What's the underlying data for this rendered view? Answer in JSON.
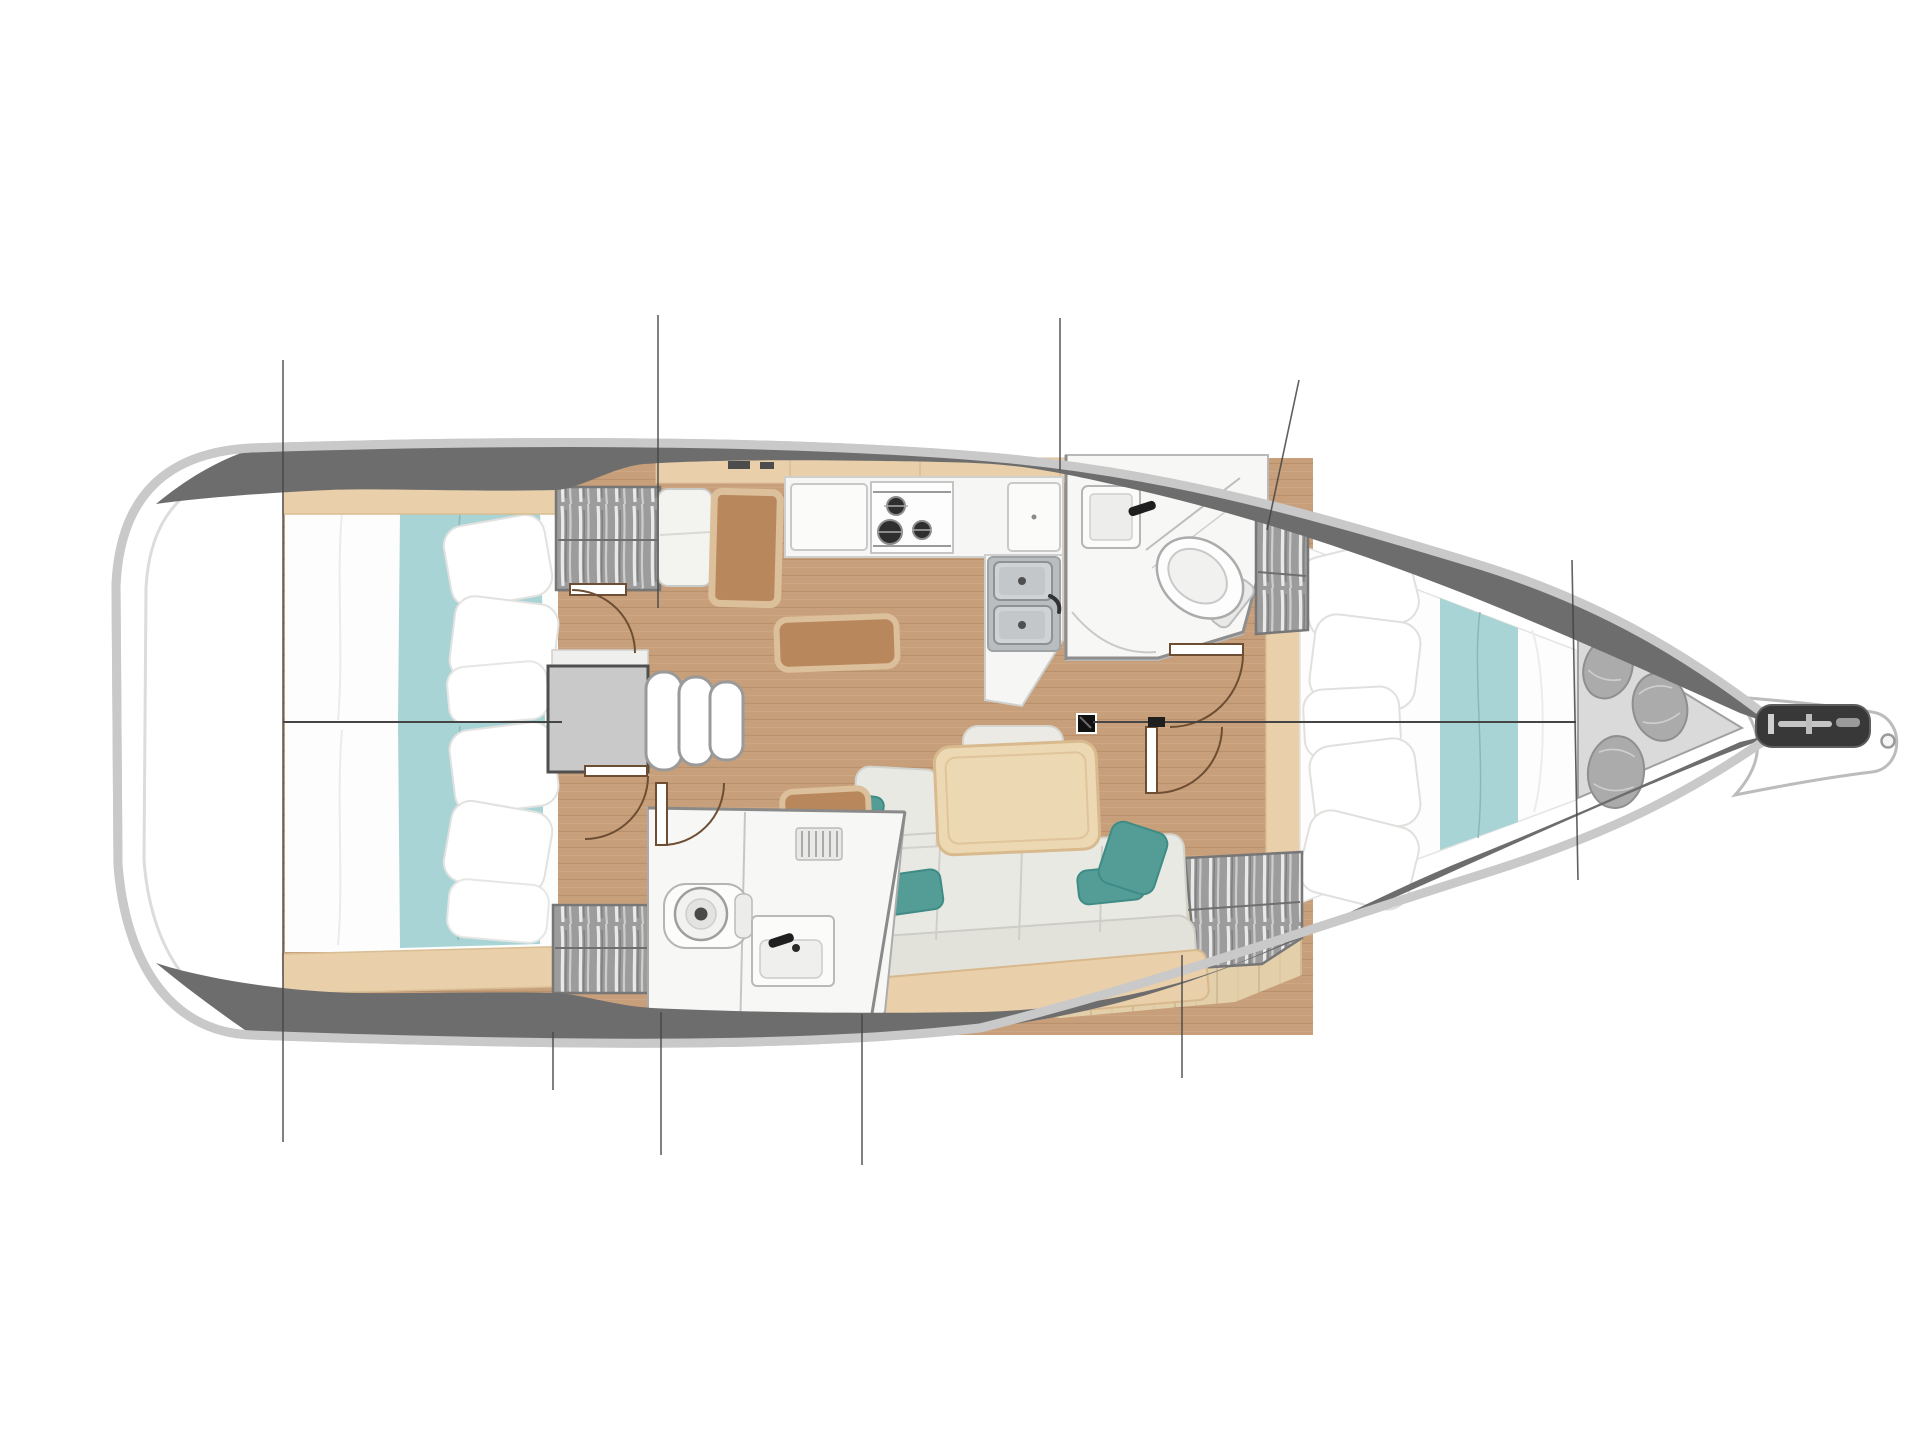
{
  "palette": {
    "hull_edge": "#c9c9c9",
    "hull_inner_line": "#dcdcdc",
    "deck_band_dark": "#585858",
    "deck_band": "#6d6d6d",
    "deck_band_light": "#7a7a7a",
    "floor_wood": "#c79f7a",
    "floor_wood_light": "#e3cfa9",
    "trim_wood": "#e9d0aa",
    "table_wood": "#ecd8b2",
    "desk_brown": "#b8875b",
    "desk_rim": "#dcbf9b",
    "teal_bedding": "#a9d4d6",
    "teal_pillow": "#549d96",
    "bed_white": "#fdfdfd",
    "room_white": "#f7f7f5",
    "wardrobe_gray": "#9c9c9c",
    "steel": "#b9bdc0",
    "landing_gray": "#c9c9c9",
    "sail_bag": "#ababab",
    "locker_floor": "#dadada",
    "line_dark": "#454545",
    "door_brown": "#6e4e33",
    "anchor_dark": "#383838"
  },
  "plan": {
    "vessel": "sailing-yacht-interior-floor-plan-top-view",
    "orientation": {
      "bow": "right",
      "stern": "left"
    },
    "rooms": [
      {
        "id": "aft-cabin-upper",
        "features": [
          "double-berth",
          "teal-runner",
          "pillows",
          "hanging-locker"
        ]
      },
      {
        "id": "aft-cabin-lower",
        "features": [
          "double-berth",
          "teal-runner",
          "pillows",
          "hanging-locker"
        ]
      },
      {
        "id": "aft-head",
        "features": [
          "toilet",
          "washbasin",
          "vent-grille"
        ]
      },
      {
        "id": "companionway",
        "features": [
          "landing",
          "three-steps",
          "seat",
          "chart-table"
        ]
      },
      {
        "id": "galley",
        "features": [
          "three-burner-stove",
          "double-sink",
          "counters",
          "storage-bench"
        ]
      },
      {
        "id": "saloon",
        "features": [
          "l-shaped-sofa",
          "dining-table",
          "bench-backrest",
          "teal-cushions",
          "mast-step"
        ]
      },
      {
        "id": "forward-head",
        "features": [
          "toilet",
          "washbasin",
          "shower-partition"
        ]
      },
      {
        "id": "forward-cabin",
        "features": [
          "v-berth",
          "teal-runner",
          "pillows",
          "two-hanging-lockers"
        ]
      },
      {
        "id": "sail-locker",
        "features": [
          "three-sail-bags"
        ]
      },
      {
        "id": "bowsprit",
        "features": [
          "anchor-roller-channel",
          "tip-ring"
        ]
      }
    ],
    "annotations": {
      "section_line_stations": 8,
      "door_swings": 5,
      "centerline": true
    }
  }
}
